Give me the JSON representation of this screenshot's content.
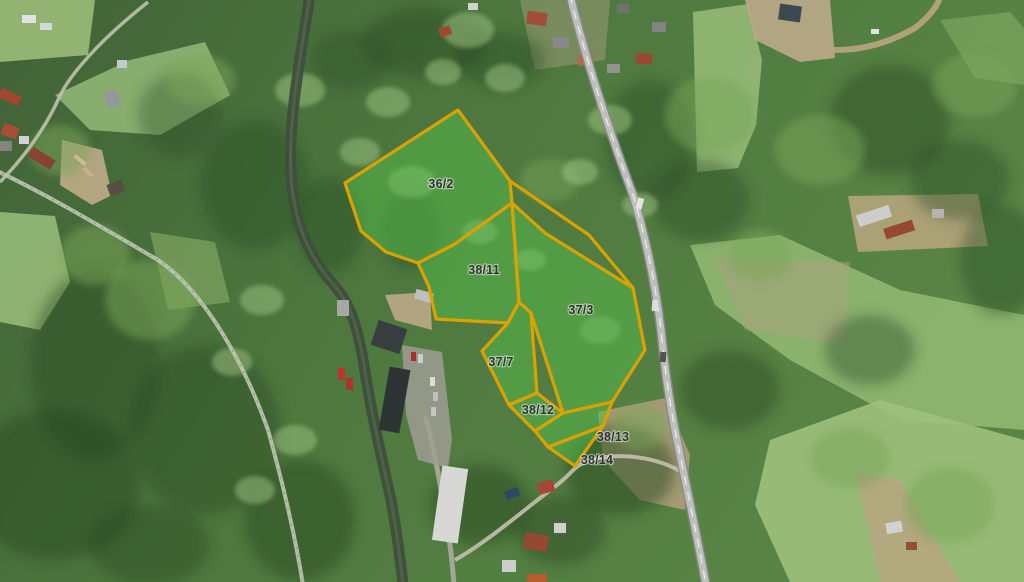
{
  "map": {
    "view": "aerial-cadastral",
    "overlay": {
      "stroke_color": "#E7A800",
      "fill_color": "rgba(88,200,80,0.48)",
      "label_color": "#333333"
    },
    "parcels": [
      {
        "label": "36/2"
      },
      {
        "label": "38/11"
      },
      {
        "label": "37/3"
      },
      {
        "label": "37/7"
      },
      {
        "label": "38/12"
      },
      {
        "label": "38/13"
      },
      {
        "label": "38/14"
      }
    ]
  }
}
